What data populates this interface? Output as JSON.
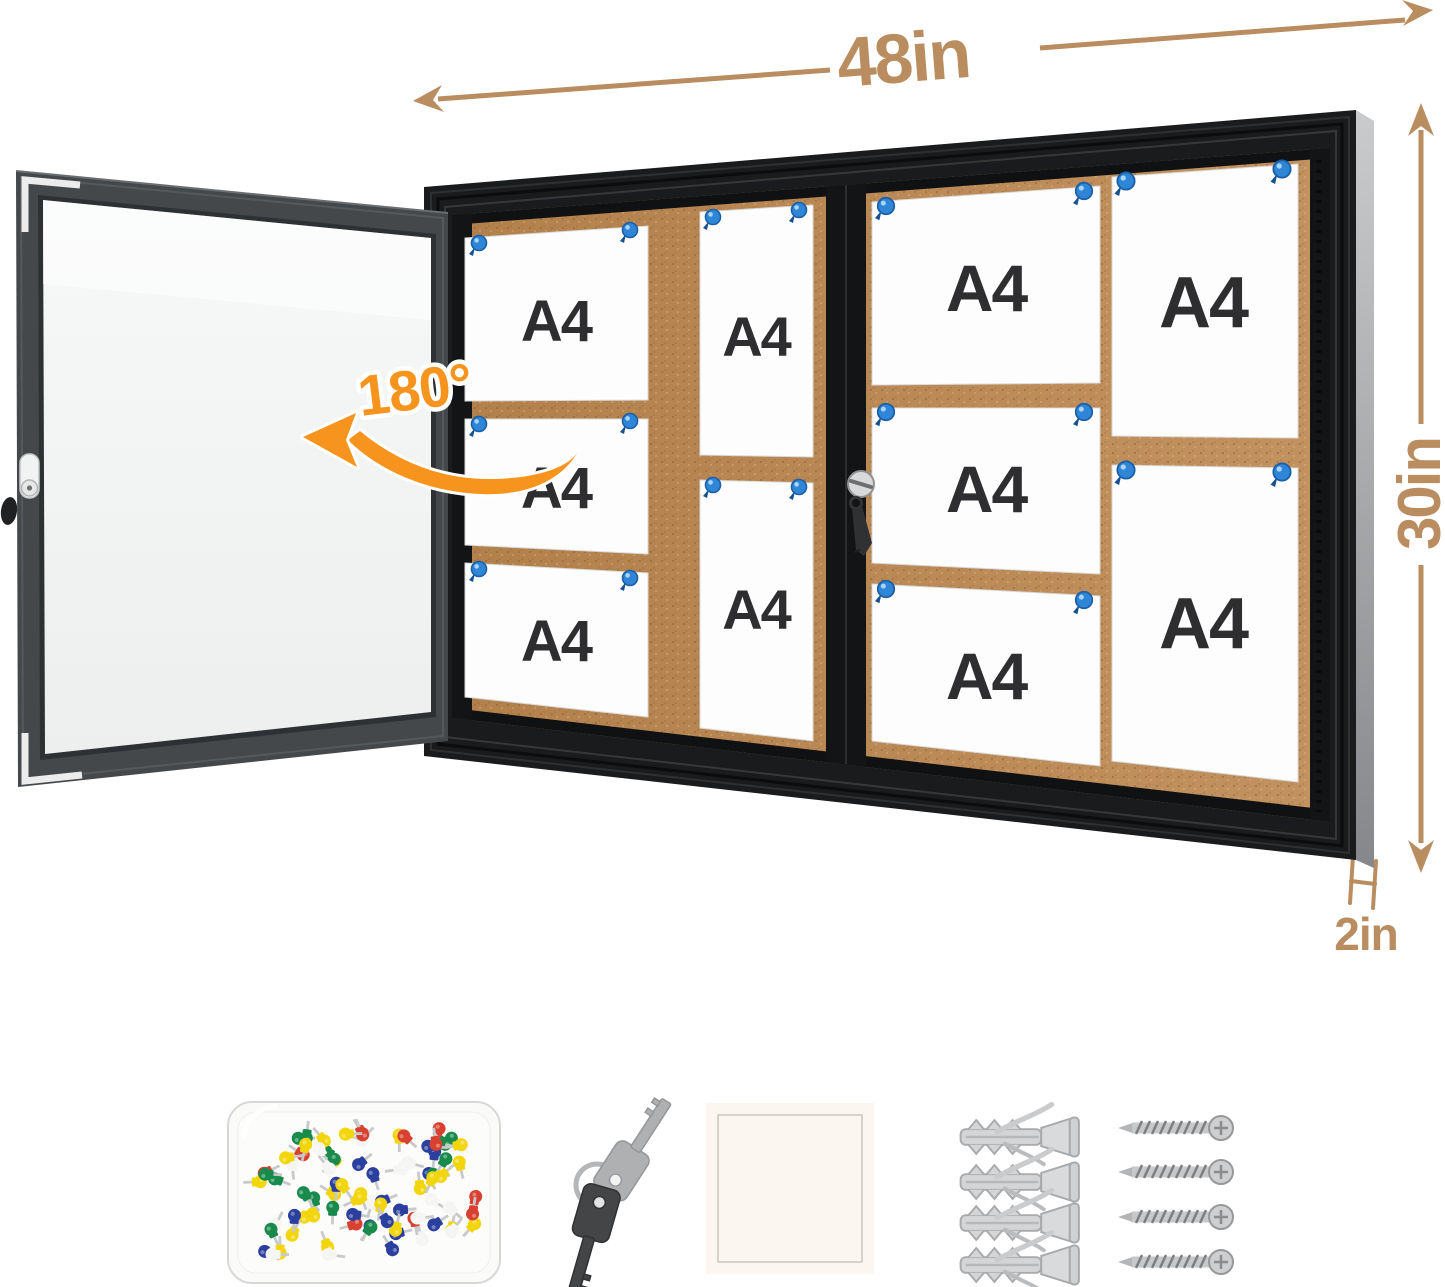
{
  "annotations": {
    "width_label": "48in",
    "height_label": "30in",
    "depth_label": "2in",
    "door_swing_label": "180°",
    "dimension_color": "#b98d5f",
    "swing_color": "#f7941e"
  },
  "board": {
    "frame_color": "#1a1c1d",
    "cork_color": "#b5834e",
    "pushpin_color": "#2f86d6",
    "sliding_door_count": 2,
    "lock_count": 2,
    "papers": [
      {
        "label": "A4",
        "orientation": "landscape",
        "section": "left"
      },
      {
        "label": "A4",
        "orientation": "landscape",
        "section": "left"
      },
      {
        "label": "A4",
        "orientation": "landscape",
        "section": "left"
      },
      {
        "label": "A4",
        "orientation": "portrait",
        "section": "left"
      },
      {
        "label": "A4",
        "orientation": "portrait",
        "section": "left"
      },
      {
        "label": "A4",
        "orientation": "landscape",
        "section": "right"
      },
      {
        "label": "A4",
        "orientation": "landscape",
        "section": "right"
      },
      {
        "label": "A4",
        "orientation": "landscape",
        "section": "right"
      },
      {
        "label": "A4",
        "orientation": "portrait",
        "section": "right"
      },
      {
        "label": "A4",
        "orientation": "portrait",
        "section": "right"
      }
    ]
  },
  "accessories": {
    "pushpin_box": {
      "pin_count": 84,
      "colors": [
        "#d8402f",
        "#2b3f9e",
        "#188a4b",
        "#f2d50a",
        "#f5f5f3"
      ]
    },
    "keys": {
      "count": 2
    },
    "mounting_pad": {
      "count": 1
    },
    "wall_anchors": {
      "count": 4
    },
    "screws": {
      "count": 4
    }
  }
}
